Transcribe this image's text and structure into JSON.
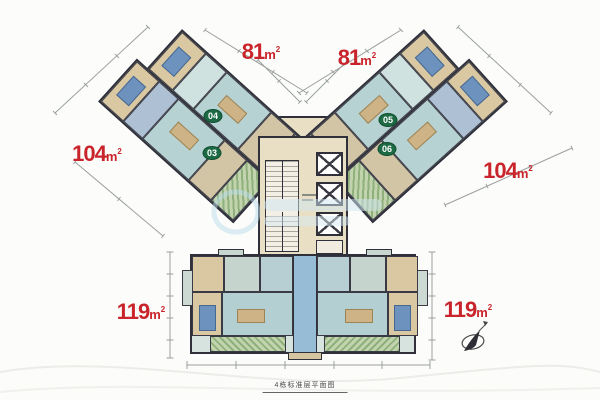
{
  "floorplan": {
    "caption": "4栋标准层平面图",
    "area_labels": [
      {
        "value": "81",
        "unit": "m",
        "sup": "2",
        "position": "top-left"
      },
      {
        "value": "81",
        "unit": "m",
        "sup": "2",
        "position": "top-right"
      },
      {
        "value": "104",
        "unit": "m",
        "sup": "2",
        "position": "mid-left"
      },
      {
        "value": "104",
        "unit": "m",
        "sup": "2",
        "position": "mid-right"
      },
      {
        "value": "119",
        "unit": "m",
        "sup": "2",
        "position": "bottom-left"
      },
      {
        "value": "119",
        "unit": "m",
        "sup": "2",
        "position": "bottom-right"
      }
    ],
    "unit_badges": [
      {
        "label": "04"
      },
      {
        "label": "03"
      },
      {
        "label": "05"
      },
      {
        "label": "06"
      }
    ],
    "colors": {
      "area_label_red": "#c9242b",
      "badge_green": "#1d6b45",
      "wall_dark": "#30303a",
      "floor_teal": "#c6dad8",
      "floor_tan": "#d9c8a2",
      "balcony_green": "#9db98a",
      "core_tan": "#e9dfc4",
      "watermark_blue": "#cfe7f2"
    }
  }
}
